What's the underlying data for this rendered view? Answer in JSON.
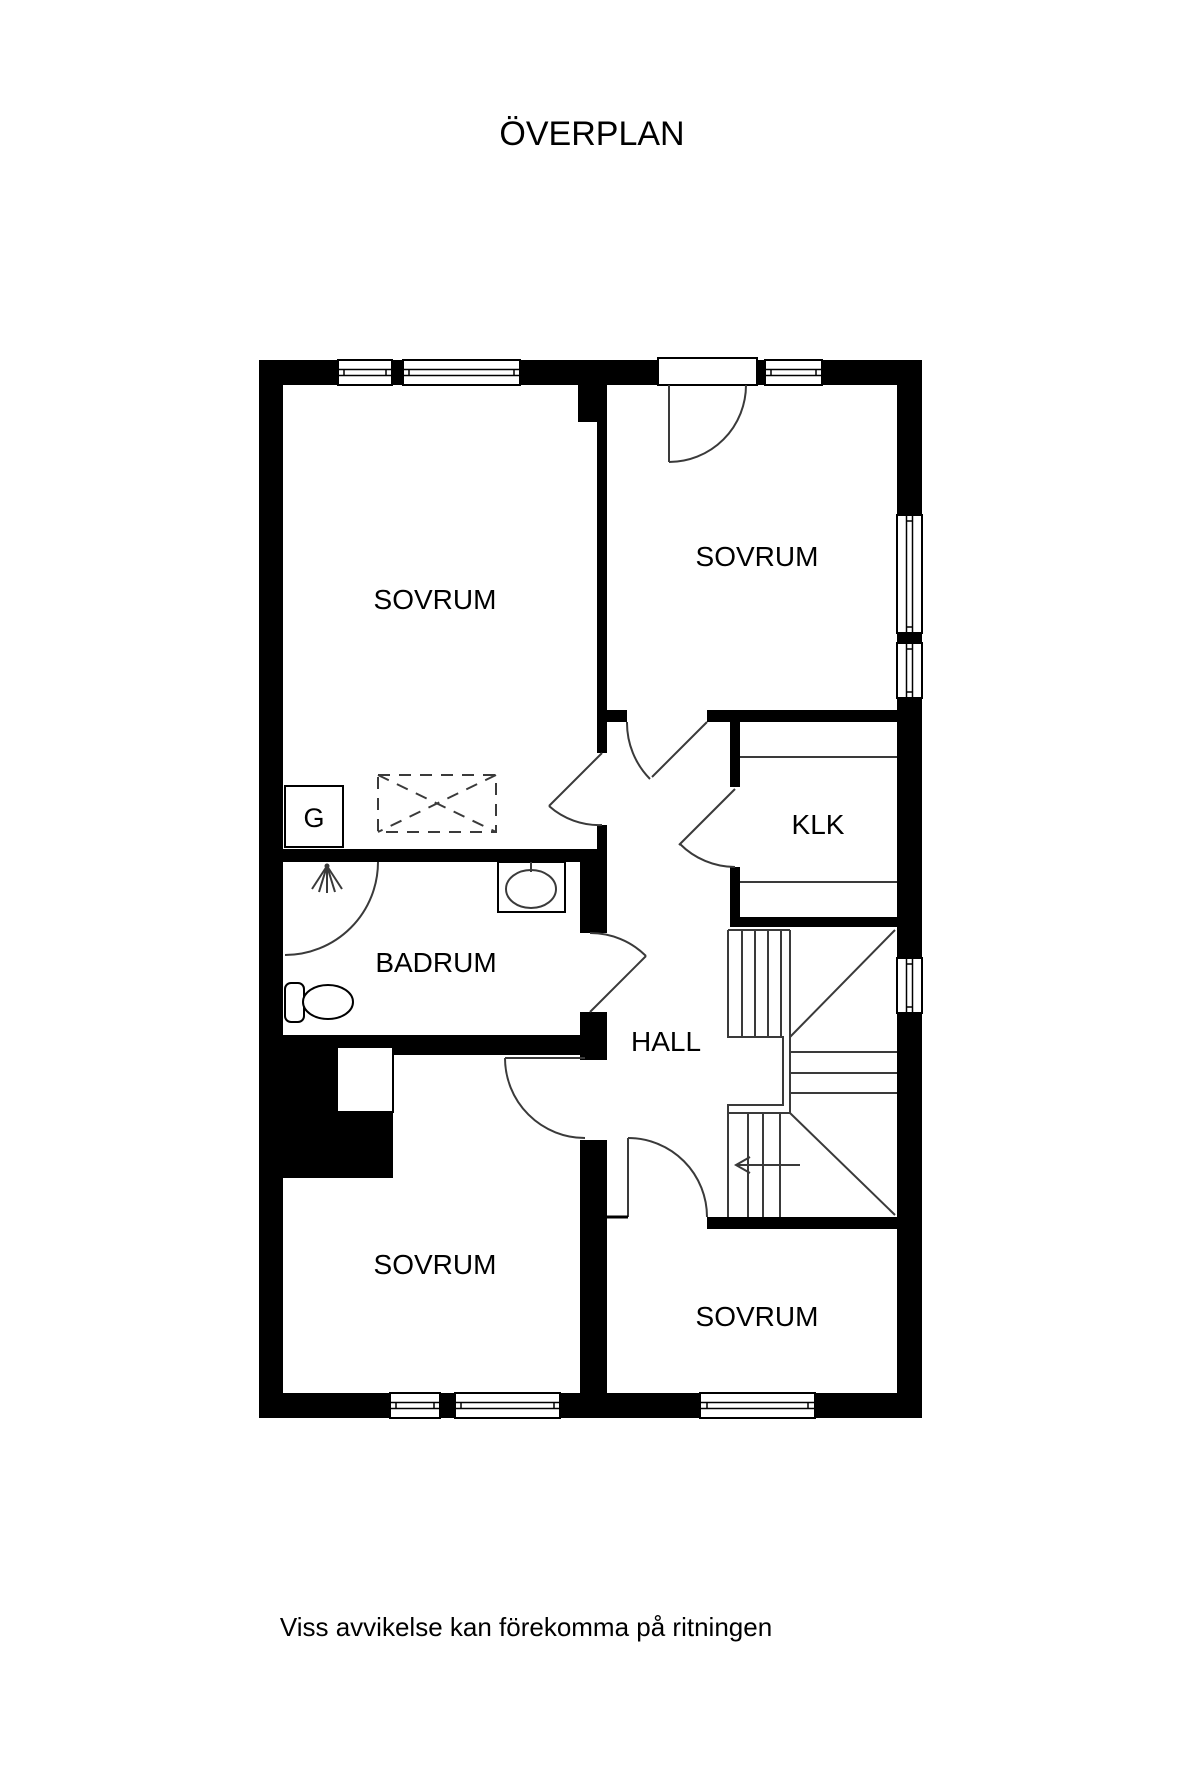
{
  "title": "ÖVERPLAN",
  "disclaimer": "Viss avvikelse kan förekomma på ritningen",
  "rooms": {
    "sovrum_top_left": "SOVRUM",
    "sovrum_top_right": "SOVRUM",
    "sovrum_bottom_left": "SOVRUM",
    "sovrum_bottom_right": "SOVRUM",
    "badrum": "BADRUM",
    "hall": "HALL",
    "klk": "KLK",
    "closet": "G"
  },
  "colors": {
    "background": "#ffffff",
    "wall": "#000000",
    "line": "#3a3a3a",
    "text": "#000000"
  }
}
